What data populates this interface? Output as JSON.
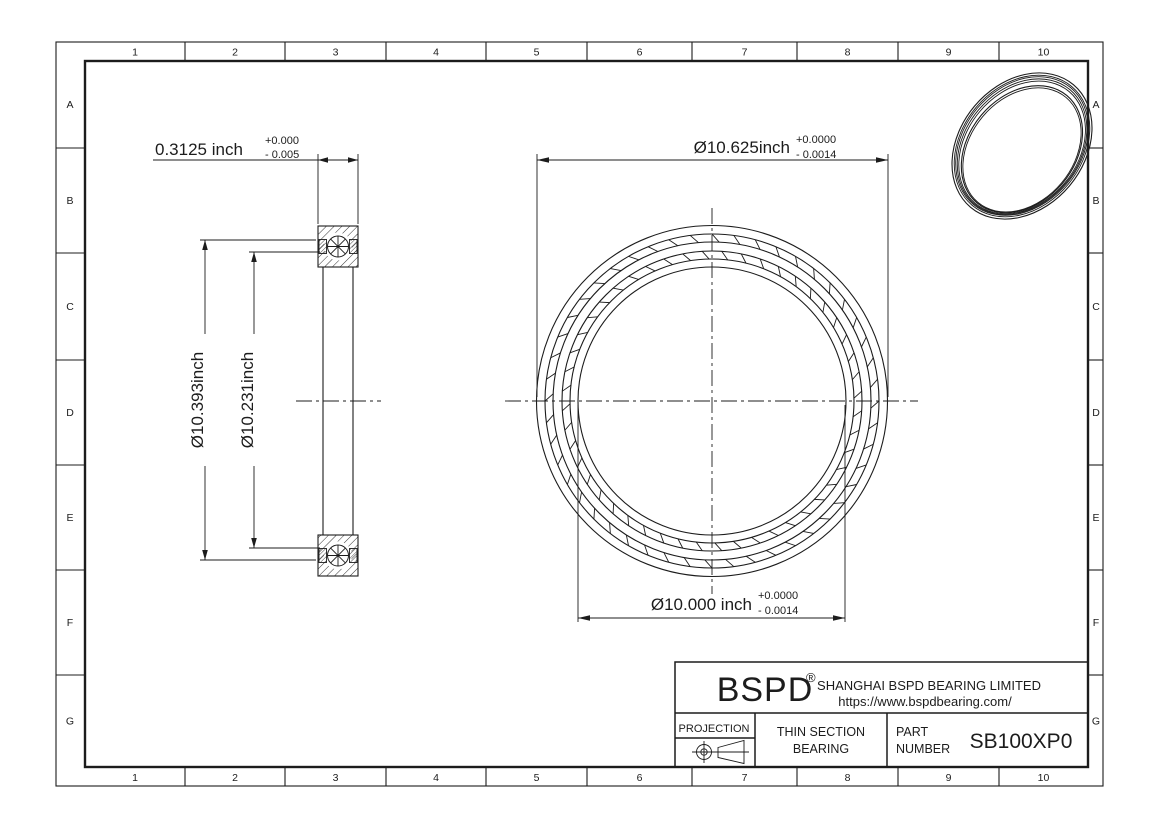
{
  "sheet": {
    "grid": {
      "columns": [
        "1",
        "2",
        "3",
        "4",
        "5",
        "6",
        "7",
        "8",
        "9",
        "10"
      ],
      "rows": [
        "A",
        "B",
        "C",
        "D",
        "E",
        "F",
        "G"
      ]
    },
    "section_view": {
      "width_dim": {
        "value": "0.3125 inch",
        "tol_upper": "+0.000",
        "tol_lower": "- 0.005"
      },
      "outer_dim": "Ø10.393inch",
      "inner_dim": "Ø10.231inch"
    },
    "front_view": {
      "od_dim": {
        "value": "Ø10.625inch",
        "tol_upper": "+0.0000",
        "tol_lower": "- 0.0014"
      },
      "bore_dim": {
        "value": "Ø10.000 inch",
        "tol_upper": "+0.0000",
        "tol_lower": "- 0.0014"
      }
    },
    "title_block": {
      "logo": "BSPD",
      "registered_mark": "®",
      "company": "SHANGHAI BSPD BEARING LIMITED",
      "website": "https://www.bspdbearing.com/",
      "projection_label": "PROJECTION",
      "product_type_line1": "THIN SECTION",
      "product_type_line2": "BEARING",
      "part_label_line1": "PART",
      "part_label_line2": "NUMBER",
      "part_number": "SB100XP0"
    },
    "colors": {
      "line": "#1c1c1c",
      "background": "#ffffff"
    }
  }
}
